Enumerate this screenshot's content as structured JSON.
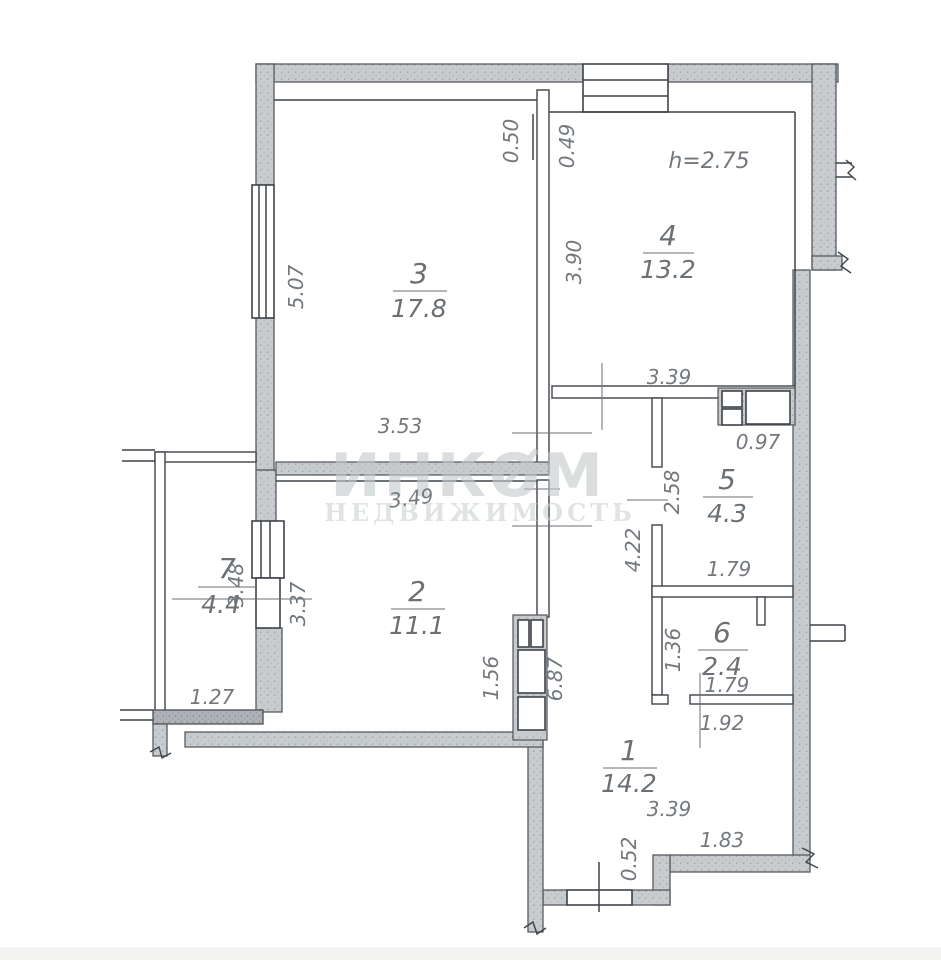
{
  "watermark": {
    "line1": "ИНКОМ",
    "line2": "НЕДВИЖИМОСТЬ"
  },
  "ceiling_height": "h=2.75",
  "rooms": [
    {
      "num": "1",
      "area": "14.2"
    },
    {
      "num": "2",
      "area": "11.1"
    },
    {
      "num": "3",
      "area": "17.8"
    },
    {
      "num": "4",
      "area": "13.2"
    },
    {
      "num": "5",
      "area": "4.3"
    },
    {
      "num": "6",
      "area": "2.4"
    },
    {
      "num": "7",
      "area": "4.4"
    }
  ],
  "dims": {
    "room3_height": "5.07",
    "offset_left": "0.50",
    "offset_right": "0.49",
    "room4_height": "3.90",
    "room4_width": "3.39",
    "room3_width": "3.53",
    "room2_width": "3.49",
    "shaft_width": "0.97",
    "room5_height": "2.58",
    "corridor_height": "4.22",
    "room5_width": "1.79",
    "room6_height": "1.36",
    "room6_width": "1.79",
    "hall_lower_width": "1.92",
    "room2_height": "3.37",
    "balcony_height": "3.48",
    "balcony_width": "1.27",
    "room1_width": "3.39",
    "bottom_right_width": "1.83",
    "bottom_step": "0.52",
    "room2_door_width": "1.56",
    "hall_full_height": "6.87"
  },
  "colors": {
    "wall_fill": "#c9ccce",
    "wall_dark": "#b2b6ba",
    "line": "#3f444a",
    "dim_text": "#73787d",
    "watermark": "#c6cacd"
  }
}
